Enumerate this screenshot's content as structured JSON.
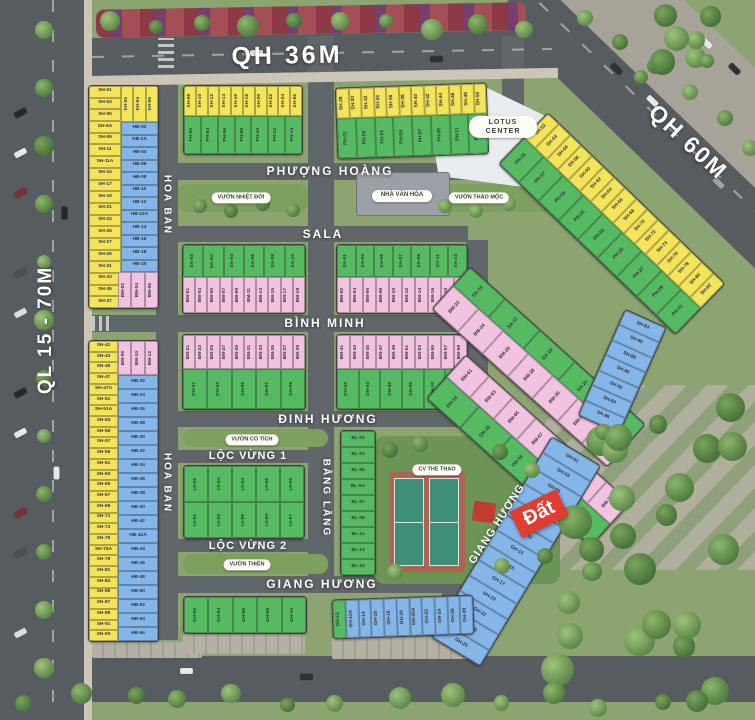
{
  "roads": {
    "qh36": "QH 36M",
    "qh60": "QH 60M",
    "ql15": "QL 15 - 70M"
  },
  "streets": {
    "phuong_hoang": "PHƯỢNG HOÀNG",
    "sala": "SALA",
    "binh_minh": "BÌNH MINH",
    "dinh_huong": "ĐINH HƯƠNG",
    "loc_vung_1": "LỘC VỪNG 1",
    "loc_vung_2": "LỘC VỪNG 2",
    "giang_huong": "GIANG HƯƠNG",
    "giang_huong_diag": "GIANG HƯƠNG",
    "hoa_ban_top": "HOA BAN",
    "hoa_ban_bottom": "HOA BAN",
    "bang_lang": "BẰNG LĂNG"
  },
  "landmarks": {
    "lotus_center": "LOTUS CENTER",
    "nha_van_hoa": "NHÀ VĂN HÓA",
    "vuon_nhiet_doi": "VƯỜN NHIỆT ĐỚI",
    "vuon_thao_moc": "VƯỜN THẢO MỘC",
    "vuon_co_tich": "VƯỜN CỔ TÍCH",
    "vuon_thien": "VƯỜN THIỀN",
    "cv_the_thao": "CV THỂ THAO"
  },
  "tag_dat": "Đất",
  "colors": {
    "lot_yellow": "#f4e45a",
    "lot_green": "#55ba62",
    "lot_pink": "#f2c3e0",
    "lot_blue": "#85b6ea",
    "tag_red": "#e23b30"
  },
  "lots": {
    "L1_sh": [
      "SH-01",
      "SH-03",
      "SH-05",
      "SH-5A",
      "SH-09",
      "SH-11",
      "SH-11A",
      "SH-15",
      "SH-17",
      "SH-19",
      "SH-21",
      "SH-23",
      "SH-25",
      "SH-27",
      "SH-29",
      "SH-31",
      "SH-33",
      "SH-35",
      "SH-37"
    ],
    "L1_top": [
      "SH-02",
      "SH-04",
      "SH-06"
    ],
    "L1_hb": [
      "HB-02",
      "HB-2A",
      "HB-04",
      "HB-06",
      "HB-08",
      "HB-10",
      "HB-12",
      "HB-12A",
      "HB-14",
      "HB-16",
      "HB-18",
      "HB-20"
    ],
    "L1_bm": [
      "BM-02",
      "BM-04",
      "BM-06"
    ],
    "L2_bm": [
      "BM-08",
      "BM-10",
      "BM-12"
    ],
    "L2_sh": [
      "SH-41",
      "SH-43",
      "SH-45",
      "SH-47",
      "SH-47A",
      "SH-51",
      "SH-51A",
      "SH-53",
      "SH-55",
      "SH-57",
      "SH-59",
      "SH-61",
      "SH-63",
      "SH-65",
      "SH-67",
      "SH-69",
      "SH-71",
      "SH-73",
      "SH-75",
      "SH-75A",
      "SH-79",
      "SH-81",
      "SH-83",
      "SH-85",
      "SH-87",
      "SH-89",
      "SH-91",
      "SH-93"
    ],
    "L2_hb": [
      "HB-22",
      "HB-24",
      "HB-26",
      "HB-28",
      "HB-30",
      "HB-32",
      "HB-34",
      "HB-36",
      "HB-38",
      "HB-40",
      "HB-42",
      "HB-42A",
      "HB-44",
      "HB-46",
      "HB-48",
      "HB-50",
      "HB-52",
      "HB-54",
      "HB-56"
    ],
    "T1_sh": [
      "SH-08",
      "SH-10",
      "SH-12",
      "SH-14",
      "SH-16",
      "SH-18",
      "SH-20",
      "SH-22",
      "SH-24",
      "SH-26"
    ],
    "T1_ph": [
      "PH-02",
      "PH-04",
      "PH-06",
      "PH-08",
      "PH-10",
      "PH-12",
      "PH-14"
    ],
    "T2_sh": [
      "SH-28",
      "SH-30",
      "SH-32",
      "SH-34",
      "SH-36",
      "SH-38",
      "SH-40",
      "SH-42",
      "SH-44",
      "SH-46",
      "SH-48",
      "SH-50"
    ],
    "T2_ph": [
      "PH-01",
      "PH-03",
      "PH-05",
      "PH-5A",
      "PH-07",
      "PH-09",
      "PH-11",
      "PH-13"
    ],
    "R1_sh": [
      "SH-52",
      "SH-54",
      "SH-56",
      "SH-58",
      "SH-60",
      "SH-62",
      "SH-64",
      "SH-66",
      "SH-68",
      "SH-70",
      "SH-72",
      "SH-74",
      "SH-76",
      "SH-78",
      "SH-80",
      "SH-82"
    ],
    "R1_ph": [
      "PH-15",
      "PH-17",
      "PH-19",
      "PH-21",
      "PH-23",
      "PH-25",
      "PH-27",
      "PH-29",
      "PH-31"
    ],
    "M1_sa": [
      "SA-02",
      "SA-2A",
      "SA-04",
      "SA-06",
      "SA-08",
      "SA-10"
    ],
    "M1_bm": [
      "BM-01",
      "BM-03",
      "BM-05",
      "BM-07",
      "BM-09",
      "BM-11",
      "BM-13",
      "BM-15",
      "BM-17",
      "BM-19"
    ],
    "M2_sa": [
      "SA-01",
      "SA-03",
      "SA-05",
      "SA-07",
      "SA-09",
      "SA-11",
      "SA-13"
    ],
    "M2_bm": [
      "BM-02",
      "BM-04",
      "BM-06",
      "BM-08",
      "BM-10",
      "BM-12",
      "BM-14",
      "BM-16",
      "BM-18",
      "BM-20"
    ],
    "M3_bm": [
      "BM-21",
      "BM-23",
      "BM-25",
      "BM-27",
      "BM-29",
      "BM-31",
      "BM-33",
      "BM-35",
      "BM-37",
      "BM-39"
    ],
    "M3_dh": [
      "DH-01",
      "DH-03",
      "DH-05",
      "DH-07",
      "DH-09"
    ],
    "M4_bm": [
      "BM-41",
      "BM-43",
      "BM-45",
      "BM-47",
      "BM-49",
      "BM-51",
      "BM-53",
      "BM-55",
      "BM-57",
      "BM-59"
    ],
    "M4_dh": [
      "DH-02",
      "DH-04",
      "DH-06",
      "DH-08",
      "DH-10",
      "DH-12"
    ],
    "R2a_sa": [
      "SA-15",
      "SA-17",
      "SA-19",
      "SA-21",
      "SA-23"
    ],
    "R2a_bm": [
      "BM-22",
      "BM-24",
      "BM-26",
      "BM-28",
      "BM-30",
      "BM-32",
      "BM-34"
    ],
    "R2b_bm": [
      "BM-61",
      "BM-63",
      "BM-65",
      "BM-67",
      "BM-69",
      "BM-71",
      "BM-73"
    ],
    "R2b_dh": [
      "DH-14",
      "DH-16",
      "DH-18",
      "DH-20",
      "DH-22"
    ],
    "R3_sh": [
      "SH-84",
      "SH-86",
      "SH-88",
      "SH-90",
      "SH-92",
      "SH-94",
      "SH-96"
    ],
    "R4_gh": [
      "GH-01",
      "GH-03",
      "GH-05",
      "GH-07",
      "GH-09",
      "GH-11",
      "GH-13",
      "GH-15",
      "GH-17",
      "GH-19",
      "GH-21",
      "GH-23",
      "GH-25"
    ],
    "LV_r1": [
      "LV-02",
      "LV-2A",
      "LV-04",
      "LV-06",
      "LV-08"
    ],
    "LV_r2": [
      "LV-01",
      "LV-03",
      "LV-05",
      "LV-5A",
      "LV-07"
    ],
    "BL": [
      "BL-01",
      "BL-03",
      "BL-05",
      "BL-5A",
      "BL-07",
      "BL-09",
      "BL-11",
      "BL-13",
      "BL-15"
    ],
    "B2_gh": [
      "GH-02",
      "GH-04",
      "GH-06",
      "GH-08",
      "GH-10"
    ],
    "B3_g": [
      "GH-12"
    ],
    "B3_gh": [
      "GH-12A",
      "GH-14",
      "GH-16",
      "GH-18",
      "GH-20",
      "GH-20A",
      "GH-22",
      "GH-24",
      "GH-26",
      "GH-28"
    ]
  }
}
